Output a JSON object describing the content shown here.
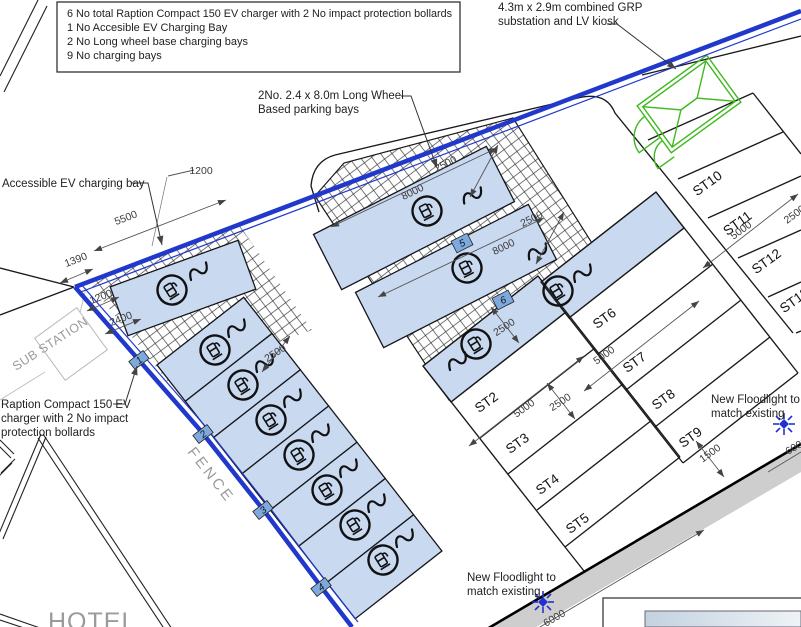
{
  "notes": {
    "lines": [
      "6 No total Raption Compact 150 EV charger with 2 No impact protection bollards",
      "1 No Accesible EV Charging Bay",
      "2 No Long wheel base charging bays",
      "9 No charging bays"
    ]
  },
  "annotations": {
    "grp_line1": "4.3m x 2.9m combined GRP",
    "grp_line2": "substation and LV kiosk",
    "lw_line1": "2No. 2.4 x 8.0m Long Wheel",
    "lw_line2": "Based parking bays",
    "accessible": "Accessible EV charging bay",
    "raption_line1": "Raption Compact 150 EV",
    "raption_line2": "charger with 2 No impact",
    "raption_line3": "protection bollards",
    "floodlight1_line1": "New Floodlight to",
    "floodlight1_line2": "match existing",
    "floodlight2_line1": "New Floodlight to",
    "floodlight2_line2": "match existing"
  },
  "labels": {
    "fence": "FENCE",
    "substation": "SUB STATION",
    "hotel": "HOTEL"
  },
  "stands": {
    "st2": "ST2",
    "st3": "ST3",
    "st4": "ST4",
    "st5": "ST5",
    "st6": "ST6",
    "st7": "ST7",
    "st8": "ST8",
    "st9": "ST9",
    "st10": "ST10",
    "st11": "ST11",
    "st12": "ST12",
    "st13": "ST13"
  },
  "markers": {
    "m1": "1",
    "m2": "2",
    "m3": "3",
    "m4": "4",
    "m5": "5",
    "m6": "6"
  },
  "dims": {
    "top1200": "1200",
    "d5500": "5500",
    "d1390": "1390",
    "left1200": "1200",
    "d2400": "2400",
    "col2500": "2500",
    "bay5_8000": "8000",
    "bay5_2500": "2500",
    "bay6_8000": "8000",
    "bay6_2500": "2500",
    "m6_2500": "2500",
    "st2_5000": "5000",
    "st_2500": "2500",
    "st6_5000": "5000",
    "st11_5000": "5000",
    "right_2500": "2500",
    "d1500": "1500",
    "path_6000": "6000",
    "right_6000": "6000"
  },
  "colors": {
    "fence_blue": "#2038cc",
    "bay_blue": "#c9d9f0",
    "marker_blue": "#7ea9dd",
    "kiosk_green": "#3fb91e"
  }
}
